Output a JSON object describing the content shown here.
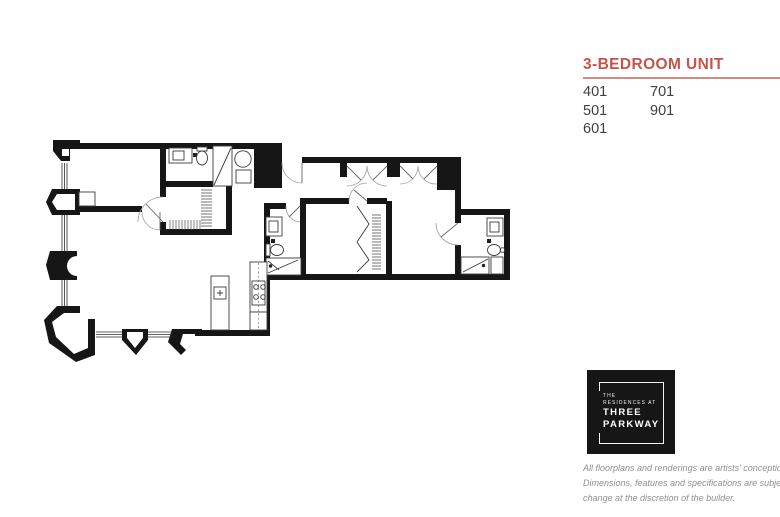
{
  "theme": {
    "accent": "#c5554a",
    "rule": "#d38a80",
    "ink": "#3f3f3f",
    "muted": "#8f8f8f",
    "logo_bg": "#161616",
    "wall": "#161616"
  },
  "unit_panel": {
    "title": "3-BEDROOM UNIT",
    "units": [
      [
        "401",
        "501",
        "601"
      ],
      [
        "701",
        "901"
      ]
    ]
  },
  "logo": {
    "lines": [
      "THE",
      "RESIDENCES AT",
      "THREE",
      "PARKWAY"
    ]
  },
  "disclaimer": {
    "lines": [
      "All floorplans and renderings are artists' conception.",
      "Dimensions, features and specifications are subject to",
      "change at the discretion of the builder."
    ]
  }
}
